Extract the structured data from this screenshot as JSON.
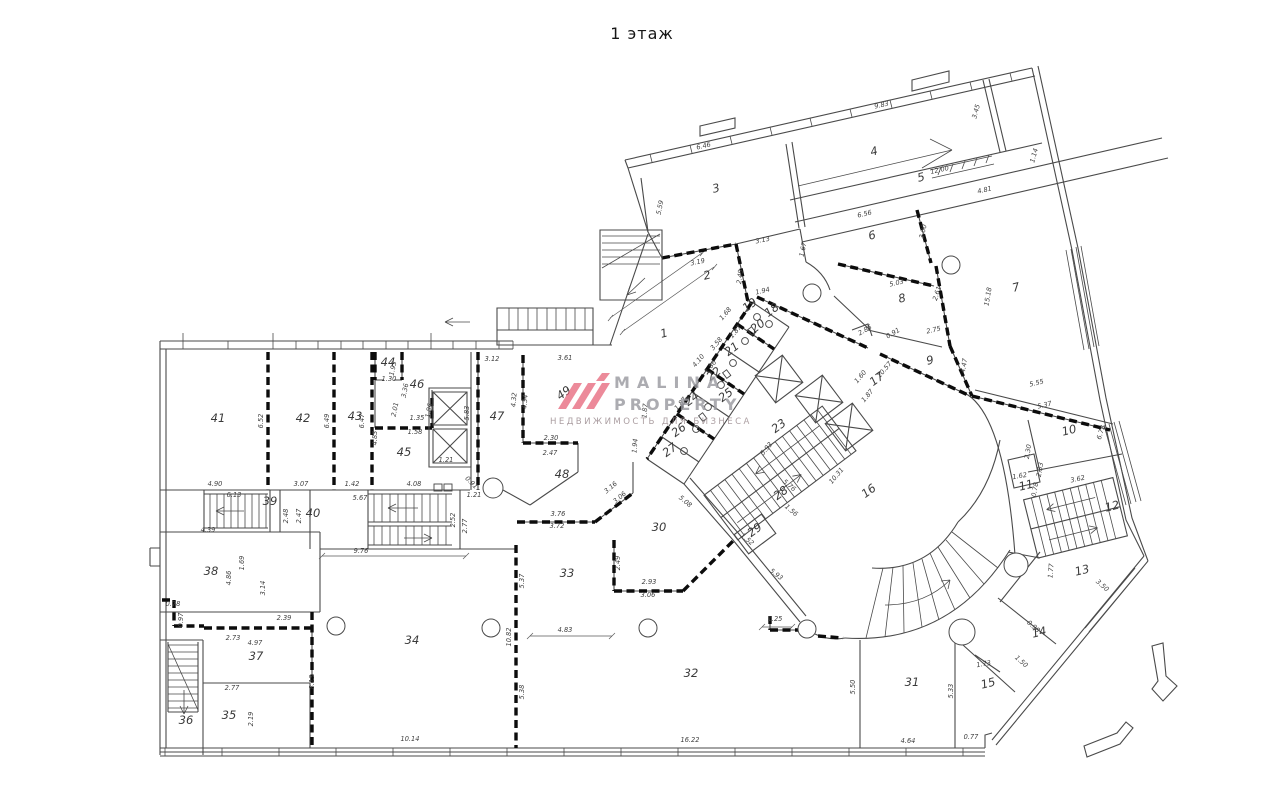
{
  "title": "1 этаж",
  "watermark": {
    "brand_line1": "MALINA",
    "brand_line2": "PROPERTY",
    "tagline": "НЕДВИЖИМОСТЬ ДЛЯ БИЗНЕСА",
    "logo_color": "#e4586f",
    "text_color": "#9a9aa0"
  },
  "plan": {
    "colors": {
      "wall": "#4a4a4a",
      "thick_wall": "#0c0c0c",
      "background": "#ffffff"
    },
    "rooms": [
      {
        "label": "41",
        "x": 218,
        "y": 422
      },
      {
        "label": "42",
        "x": 303,
        "y": 422
      },
      {
        "label": "43",
        "x": 355,
        "y": 420
      },
      {
        "label": "44",
        "x": 388,
        "y": 366
      },
      {
        "label": "46",
        "x": 417,
        "y": 388
      },
      {
        "label": "45",
        "x": 404,
        "y": 456
      },
      {
        "label": "47",
        "x": 497,
        "y": 420
      },
      {
        "label": "49",
        "x": 566,
        "y": 396,
        "r": -37
      },
      {
        "label": "48",
        "x": 562,
        "y": 478
      },
      {
        "label": "39",
        "x": 270,
        "y": 505
      },
      {
        "label": "40",
        "x": 313,
        "y": 517
      },
      {
        "label": "38",
        "x": 211,
        "y": 575
      },
      {
        "label": "37",
        "x": 256,
        "y": 660
      },
      {
        "label": "35",
        "x": 229,
        "y": 719
      },
      {
        "label": "36",
        "x": 186,
        "y": 724
      },
      {
        "label": "34",
        "x": 412,
        "y": 644
      },
      {
        "label": "33",
        "x": 567,
        "y": 577
      },
      {
        "label": "30",
        "x": 659,
        "y": 531
      },
      {
        "label": "32",
        "x": 691,
        "y": 677
      },
      {
        "label": "31",
        "x": 912,
        "y": 686
      },
      {
        "label": "15",
        "x": 989,
        "y": 687,
        "r": -14
      },
      {
        "label": "14",
        "x": 1040,
        "y": 636,
        "r": -14
      },
      {
        "label": "13",
        "x": 1083,
        "y": 574,
        "r": -14
      },
      {
        "label": "12",
        "x": 1113,
        "y": 510,
        "r": -14
      },
      {
        "label": "11",
        "x": 1027,
        "y": 489,
        "r": -14
      },
      {
        "label": "10",
        "x": 1070,
        "y": 434,
        "r": -14
      },
      {
        "label": "16",
        "x": 871,
        "y": 494,
        "r": -37
      },
      {
        "label": "23",
        "x": 781,
        "y": 429,
        "r": -37
      },
      {
        "label": "28",
        "x": 783,
        "y": 496,
        "r": -37
      },
      {
        "label": "29",
        "x": 757,
        "y": 533,
        "r": -37
      },
      {
        "label": "26",
        "x": 681,
        "y": 433,
        "r": -37
      },
      {
        "label": "27",
        "x": 672,
        "y": 453,
        "r": -37
      },
      {
        "label": "24",
        "x": 694,
        "y": 402,
        "r": -37
      },
      {
        "label": "25",
        "x": 728,
        "y": 398,
        "r": -37
      },
      {
        "label": "22",
        "x": 716,
        "y": 377,
        "r": -37
      },
      {
        "label": "21",
        "x": 734,
        "y": 352,
        "r": -37
      },
      {
        "label": "20",
        "x": 760,
        "y": 329,
        "r": -37
      },
      {
        "label": "19",
        "x": 752,
        "y": 308,
        "r": -37
      },
      {
        "label": "18",
        "x": 774,
        "y": 313,
        "r": -37
      },
      {
        "label": "17",
        "x": 879,
        "y": 382,
        "r": -37
      },
      {
        "label": "1",
        "x": 665,
        "y": 337,
        "r": -14
      },
      {
        "label": "2",
        "x": 708,
        "y": 279,
        "r": -14
      },
      {
        "label": "3",
        "x": 717,
        "y": 192,
        "r": -14
      },
      {
        "label": "4",
        "x": 875,
        "y": 155,
        "r": -14
      },
      {
        "label": "5",
        "x": 922,
        "y": 181,
        "r": -14
      },
      {
        "label": "6",
        "x": 873,
        "y": 239,
        "r": -14
      },
      {
        "label": "7",
        "x": 1017,
        "y": 291,
        "r": -14
      },
      {
        "label": "8",
        "x": 903,
        "y": 302,
        "r": -14
      },
      {
        "label": "9",
        "x": 931,
        "y": 364,
        "r": -14
      }
    ],
    "dimensions": [
      {
        "t": "4.90",
        "x": 215,
        "y": 486
      },
      {
        "t": "6.52",
        "x": 263,
        "y": 421,
        "r": -90
      },
      {
        "t": "3.07",
        "x": 301,
        "y": 486
      },
      {
        "t": "6.49",
        "x": 329,
        "y": 421,
        "r": -90
      },
      {
        "t": "6.47",
        "x": 364,
        "y": 421,
        "r": -90
      },
      {
        "t": "1.42",
        "x": 352,
        "y": 486
      },
      {
        "t": "1.93",
        "x": 395,
        "y": 369,
        "r": -78
      },
      {
        "t": "1.30",
        "x": 389,
        "y": 381
      },
      {
        "t": "3.36",
        "x": 407,
        "y": 391,
        "r": -78
      },
      {
        "t": "2.01",
        "x": 397,
        "y": 410,
        "r": -78
      },
      {
        "t": "1.35",
        "x": 417,
        "y": 420
      },
      {
        "t": "1.58",
        "x": 415,
        "y": 434
      },
      {
        "t": "1.86",
        "x": 431,
        "y": 411,
        "r": -78
      },
      {
        "t": "1.21",
        "x": 446,
        "y": 462
      },
      {
        "t": "5.83",
        "x": 469,
        "y": 413,
        "r": -90
      },
      {
        "t": "4.83",
        "x": 377,
        "y": 438,
        "r": -90
      },
      {
        "t": "4.08",
        "x": 414,
        "y": 486
      },
      {
        "t": "0.91",
        "x": 470,
        "y": 484,
        "r": 45
      },
      {
        "t": "1.21",
        "x": 474,
        "y": 497
      },
      {
        "t": "3.12",
        "x": 492,
        "y": 361
      },
      {
        "t": "3.61",
        "x": 565,
        "y": 360
      },
      {
        "t": "6.13",
        "x": 234,
        "y": 497
      },
      {
        "t": "5.67",
        "x": 360,
        "y": 500
      },
      {
        "t": "2.48",
        "x": 288,
        "y": 516,
        "r": -90
      },
      {
        "t": "2.47",
        "x": 301,
        "y": 516,
        "r": -90
      },
      {
        "t": "9.76",
        "x": 361,
        "y": 553
      },
      {
        "t": "2.52",
        "x": 455,
        "y": 520,
        "r": -90
      },
      {
        "t": "2.77",
        "x": 467,
        "y": 526,
        "r": -90
      },
      {
        "t": "4.39",
        "x": 208,
        "y": 532
      },
      {
        "t": "1.69",
        "x": 244,
        "y": 563,
        "r": -90
      },
      {
        "t": "4.86",
        "x": 231,
        "y": 578,
        "r": -90
      },
      {
        "t": "3.14",
        "x": 265,
        "y": 588,
        "r": -90
      },
      {
        "t": "0.78",
        "x": 173,
        "y": 606
      },
      {
        "t": "0.97",
        "x": 183,
        "y": 620,
        "r": -90
      },
      {
        "t": "2.73",
        "x": 233,
        "y": 640
      },
      {
        "t": "2.39",
        "x": 284,
        "y": 620
      },
      {
        "t": "4.97",
        "x": 255,
        "y": 645
      },
      {
        "t": "2.77",
        "x": 232,
        "y": 690
      },
      {
        "t": "2.19",
        "x": 253,
        "y": 719,
        "r": -90
      },
      {
        "t": "8.13",
        "x": 314,
        "y": 682,
        "r": -90
      },
      {
        "t": "10.14",
        "x": 410,
        "y": 741
      },
      {
        "t": "10.82",
        "x": 511,
        "y": 637,
        "r": -90
      },
      {
        "t": "5.37",
        "x": 524,
        "y": 581,
        "r": -90
      },
      {
        "t": "5.38",
        "x": 524,
        "y": 692,
        "r": -90
      },
      {
        "t": "4.83",
        "x": 565,
        "y": 632
      },
      {
        "t": "16.22",
        "x": 690,
        "y": 742
      },
      {
        "t": "4.64",
        "x": 908,
        "y": 743
      },
      {
        "t": "0.77",
        "x": 971,
        "y": 739
      },
      {
        "t": "5.50",
        "x": 855,
        "y": 687,
        "r": -90
      },
      {
        "t": "5.33",
        "x": 953,
        "y": 691,
        "r": -90
      },
      {
        "t": "2.49",
        "x": 620,
        "y": 563,
        "r": -90
      },
      {
        "t": "2.93",
        "x": 649,
        "y": 584
      },
      {
        "t": "3.06",
        "x": 648,
        "y": 597
      },
      {
        "t": "1.25",
        "x": 775,
        "y": 621
      },
      {
        "t": "5.93",
        "x": 775,
        "y": 576,
        "r": 38
      },
      {
        "t": "3.16",
        "x": 612,
        "y": 489,
        "r": -40
      },
      {
        "t": "3.06",
        "x": 621,
        "y": 499,
        "r": -40
      },
      {
        "t": "5.08",
        "x": 684,
        "y": 503,
        "r": 40
      },
      {
        "t": "3.76",
        "x": 558,
        "y": 516
      },
      {
        "t": "3.72",
        "x": 557,
        "y": 528
      },
      {
        "t": "2.30",
        "x": 551,
        "y": 440
      },
      {
        "t": "2.47",
        "x": 550,
        "y": 455
      },
      {
        "t": "4.32",
        "x": 516,
        "y": 400,
        "r": -85
      },
      {
        "t": "4.34",
        "x": 527,
        "y": 402,
        "r": -85
      },
      {
        "t": "1.94",
        "x": 637,
        "y": 446,
        "r": -85
      },
      {
        "t": "1.87",
        "x": 647,
        "y": 411,
        "r": -85
      },
      {
        "t": "1.94",
        "x": 763,
        "y": 293,
        "r": -13
      },
      {
        "t": "1.68",
        "x": 727,
        "y": 315,
        "r": -50
      },
      {
        "t": "1.87",
        "x": 737,
        "y": 333,
        "r": -50
      },
      {
        "t": "3.58",
        "x": 718,
        "y": 345,
        "r": -50
      },
      {
        "t": "1.86",
        "x": 712,
        "y": 368,
        "r": -50
      },
      {
        "t": "4.10",
        "x": 700,
        "y": 362,
        "r": -50
      },
      {
        "t": "1.87",
        "x": 682,
        "y": 405,
        "r": -50
      },
      {
        "t": "5.93",
        "x": 768,
        "y": 450,
        "r": -50
      },
      {
        "t": "5.76",
        "x": 788,
        "y": 487,
        "r": 40
      },
      {
        "t": "1.56",
        "x": 790,
        "y": 512,
        "r": 40
      },
      {
        "t": "1.52",
        "x": 746,
        "y": 541,
        "r": 40
      },
      {
        "t": "10.31",
        "x": 838,
        "y": 477,
        "r": -50
      },
      {
        "t": "3.19",
        "x": 698,
        "y": 264,
        "r": -12
      },
      {
        "t": "3.13",
        "x": 763,
        "y": 242,
        "r": -12
      },
      {
        "t": "1.67",
        "x": 805,
        "y": 250,
        "r": -78
      },
      {
        "t": "2.49",
        "x": 742,
        "y": 277,
        "r": -82
      },
      {
        "t": "6.46",
        "x": 704,
        "y": 148,
        "r": -13
      },
      {
        "t": "5.59",
        "x": 662,
        "y": 208,
        "r": -78
      },
      {
        "t": "9.83",
        "x": 882,
        "y": 107,
        "r": -13
      },
      {
        "t": "3.45",
        "x": 978,
        "y": 112,
        "r": -75
      },
      {
        "t": "12.00",
        "x": 940,
        "y": 172,
        "r": -13
      },
      {
        "t": "4.81",
        "x": 985,
        "y": 192,
        "r": -13
      },
      {
        "t": "1.14",
        "x": 1036,
        "y": 156,
        "r": -75
      },
      {
        "t": "6.56",
        "x": 865,
        "y": 216,
        "r": -13
      },
      {
        "t": "3.00",
        "x": 925,
        "y": 232,
        "r": -77
      },
      {
        "t": "5.03",
        "x": 897,
        "y": 285,
        "r": -13
      },
      {
        "t": "2.61",
        "x": 939,
        "y": 294,
        "r": -72
      },
      {
        "t": "2.85",
        "x": 866,
        "y": 332,
        "r": -30
      },
      {
        "t": "0.91",
        "x": 894,
        "y": 335,
        "r": -30
      },
      {
        "t": "2.75",
        "x": 934,
        "y": 332,
        "r": -13
      },
      {
        "t": "10.57",
        "x": 886,
        "y": 371,
        "r": -50
      },
      {
        "t": "1.60",
        "x": 862,
        "y": 378,
        "r": -50
      },
      {
        "t": "1.87",
        "x": 869,
        "y": 397,
        "r": -50
      },
      {
        "t": "15.18",
        "x": 990,
        "y": 297,
        "r": -80
      },
      {
        "t": "4.47",
        "x": 966,
        "y": 366,
        "r": -80
      },
      {
        "t": "5.55",
        "x": 1037,
        "y": 385,
        "r": -13
      },
      {
        "t": "5.37",
        "x": 1045,
        "y": 407,
        "r": -13
      },
      {
        "t": "6.73",
        "x": 1103,
        "y": 433,
        "r": -72
      },
      {
        "t": "3.62",
        "x": 1078,
        "y": 481,
        "r": -12
      },
      {
        "t": "2.33",
        "x": 1042,
        "y": 470,
        "r": -80
      },
      {
        "t": "2.30",
        "x": 1030,
        "y": 452,
        "r": -80
      },
      {
        "t": "1.62",
        "x": 1020,
        "y": 478,
        "r": -10
      },
      {
        "t": "0.78",
        "x": 1037,
        "y": 490,
        "r": -80
      },
      {
        "t": "3.50",
        "x": 1101,
        "y": 587,
        "r": 42
      },
      {
        "t": "1.77",
        "x": 1053,
        "y": 571,
        "r": -85
      },
      {
        "t": "1.73",
        "x": 984,
        "y": 666,
        "r": -10
      },
      {
        "t": "1.50",
        "x": 1020,
        "y": 663,
        "r": 42
      },
      {
        "t": "0.98",
        "x": 1032,
        "y": 628,
        "r": 42
      }
    ]
  }
}
